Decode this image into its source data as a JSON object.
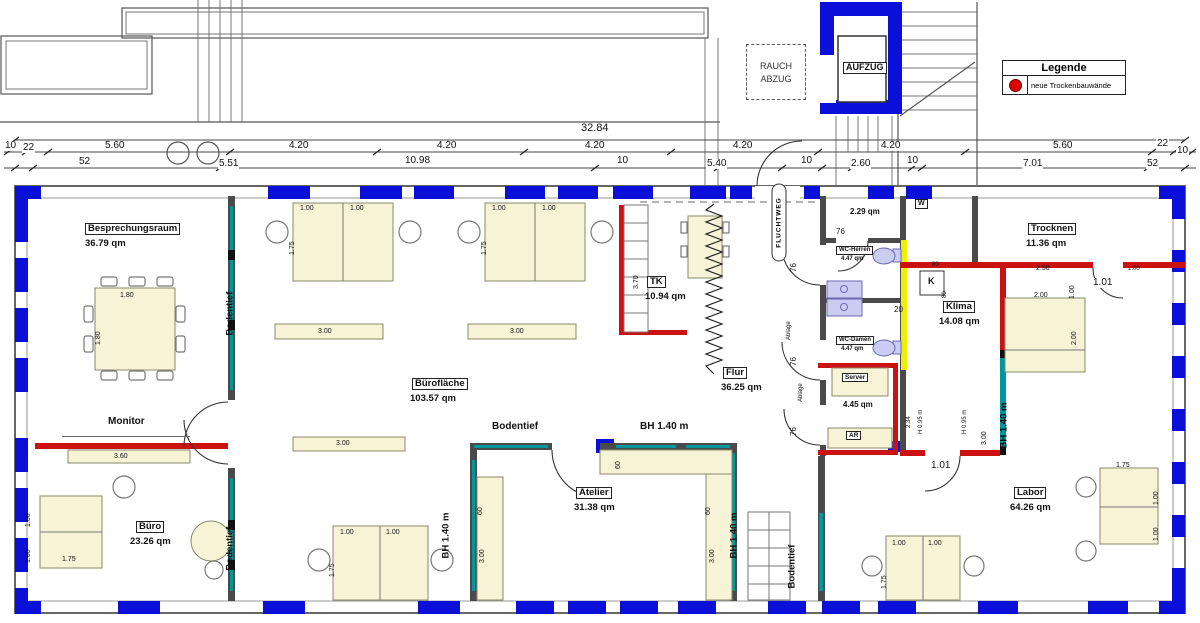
{
  "colors": {
    "window_blue": "#0a10d8",
    "new_wall_red": "#cc1111",
    "glass_teal": "#00979c",
    "shaft_yellow": "#f2ee00",
    "furniture_beige": "#f6f3d7",
    "fixture_purple": "#c9cdf2",
    "legend_dot_red": "#dd0000"
  },
  "legend": {
    "title": "Legende",
    "item": "neue Trockenbauwände"
  },
  "annex": {
    "rauch1": "RAUCH",
    "rauch2": "ABZUG",
    "aufzug": "AUFZUG"
  },
  "dims": {
    "overall": "32.84",
    "row2": [
      "10",
      "22",
      "5.60",
      "4.20",
      "4.20",
      "4.20",
      "4.20",
      "4.20",
      "5.60",
      "22",
      "10"
    ],
    "row3": [
      "52",
      "5.51",
      "10.98",
      "10",
      "5.40",
      "10",
      "2.60",
      "10",
      "7.01",
      "52"
    ]
  },
  "rooms": {
    "besprechungsraum": {
      "name": "Besprechungsraum",
      "area": "36.79 qm"
    },
    "bueroflaeche": {
      "name": "Bürofläche",
      "area": "103.57 qm"
    },
    "buero": {
      "name": "Büro",
      "area": "23.26 qm"
    },
    "tk": {
      "name": "TK",
      "area": "10.94 qm"
    },
    "flur": {
      "name": "Flur",
      "area": "36.25 qm"
    },
    "atelier": {
      "name": "Atelier",
      "area": "31.38 qm"
    },
    "server": {
      "name": "Server",
      "area": "4.45 qm"
    },
    "wc_herren": {
      "name": "WC-Herren",
      "area": "4.47 qm"
    },
    "wc_damen": {
      "name": "WC-Damen",
      "area": "4.47 qm"
    },
    "wc_vorraum": {
      "area": "2.29 qm"
    },
    "klima": {
      "name": "Klima",
      "area": "14.08 qm"
    },
    "trocknen": {
      "name": "Trocknen",
      "area": "11.36 qm"
    },
    "labor": {
      "name": "Labor",
      "area": "64.26 qm"
    }
  },
  "labels": {
    "monitor": "Monitor",
    "bodentief": "Bodentief",
    "bh140": "BH 1.40 m",
    "fluchtweg": "FLUCHTWEG",
    "h095": "H 0.95 m",
    "ablage": "Ablage",
    "w": "W",
    "k": "K",
    "ar": "AR"
  },
  "fdims": {
    "d180": "1.80",
    "d175": "1.75",
    "d100": "1.00",
    "d300": "3.00",
    "d360": "3.60",
    "d370": "3.70",
    "d060": "60",
    "d200": "2.00",
    "d250": "2.50",
    "d234": "2.34",
    "d076": "76",
    "d020": "20",
    "d101": "1.01",
    "d080": "80"
  }
}
